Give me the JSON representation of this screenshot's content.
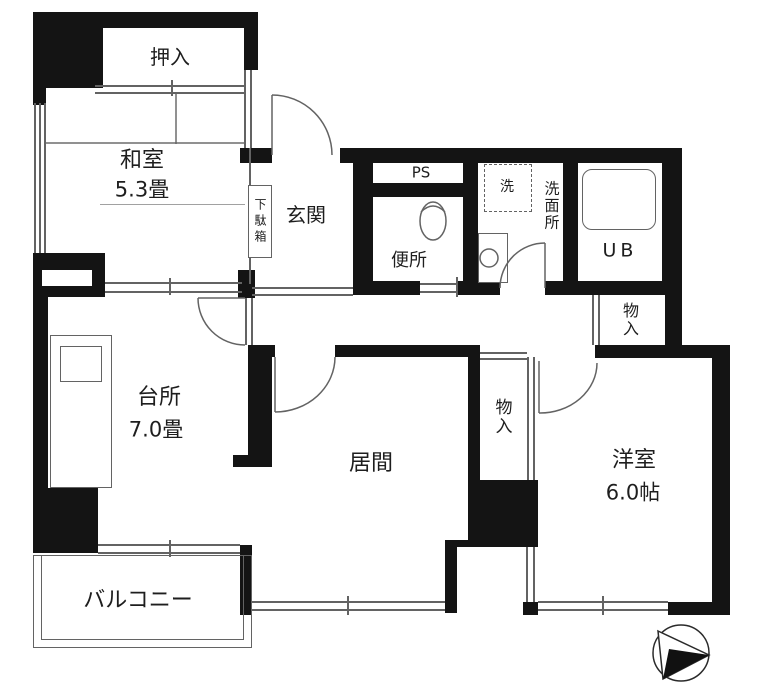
{
  "plan": {
    "title": "apartment-floor-plan",
    "rooms": {
      "oshiire": {
        "label": "押入"
      },
      "washitsu": {
        "label": "和室",
        "size": "5.3畳"
      },
      "genkan": {
        "label": "玄関"
      },
      "getabako": {
        "label": "下駄箱"
      },
      "ps": {
        "label": "PS"
      },
      "benjo": {
        "label": "便所"
      },
      "washer": {
        "label": "洗"
      },
      "senmenjo": {
        "label": "洗面所"
      },
      "unit_bath": {
        "label": "UB"
      },
      "monoire_hall": {
        "label": "物入"
      },
      "monoire_living": {
        "label": "物入"
      },
      "daidokoro": {
        "label": "台所",
        "size": "7.0畳"
      },
      "ima": {
        "label": "居間"
      },
      "yoshitsu": {
        "label": "洋室",
        "size": "6.0帖"
      },
      "balcony": {
        "label": "バルコニー"
      }
    },
    "icons": {
      "compass": "north-arrow"
    },
    "colors": {
      "wall": "#141414",
      "thin_line": "#636363",
      "background": "#ffffff",
      "text": "#1e1e1e"
    }
  }
}
